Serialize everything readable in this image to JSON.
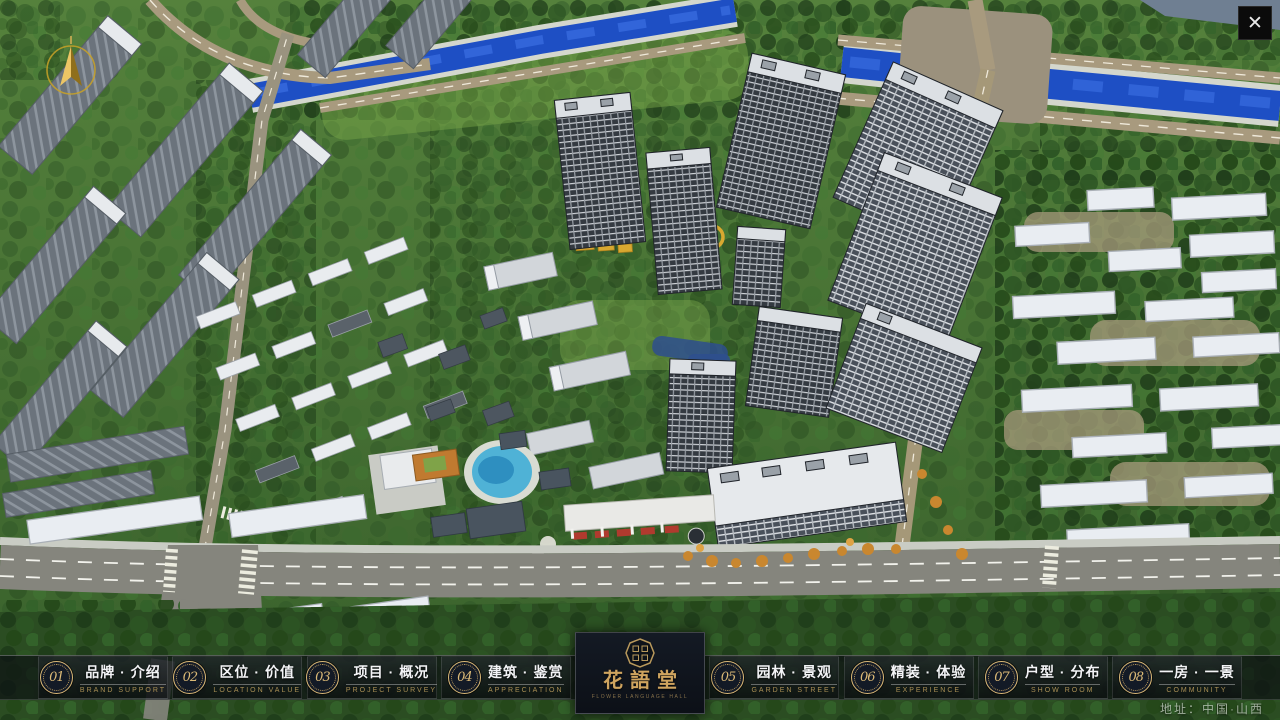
{
  "window": {
    "close_glyph": "✕"
  },
  "menu": {
    "items": [
      {
        "num": "01",
        "zh": "品牌 · 介绍",
        "en": "BRAND SUPPORT"
      },
      {
        "num": "02",
        "zh": "区位 · 价值",
        "en": "LOCATION VALUE"
      },
      {
        "num": "03",
        "zh": "项目 · 概况",
        "en": "PROJECT SURVEY"
      },
      {
        "num": "04",
        "zh": "建筑 · 鉴赏",
        "en": "APPRECIATION"
      },
      {
        "num": "05",
        "zh": "园林 · 景观",
        "en": "GARDEN STREET"
      },
      {
        "num": "06",
        "zh": "精装 · 体验",
        "en": "EXPERIENCE"
      },
      {
        "num": "07",
        "zh": "户型 · 分布",
        "en": "SHOW ROOM"
      },
      {
        "num": "08",
        "zh": "一房 · 一景",
        "en": "COMMUNITY"
      }
    ]
  },
  "logo": {
    "title": "花語堂",
    "subtitle": "FLOWER LANGUAGE HALL"
  },
  "footer": {
    "address": "地址：中国·山西"
  },
  "colors": {
    "gold": "#c9a96a",
    "bar_background": "#14181e",
    "river_blue": "#1e4fc4",
    "accent_red": "#b03a2e"
  }
}
